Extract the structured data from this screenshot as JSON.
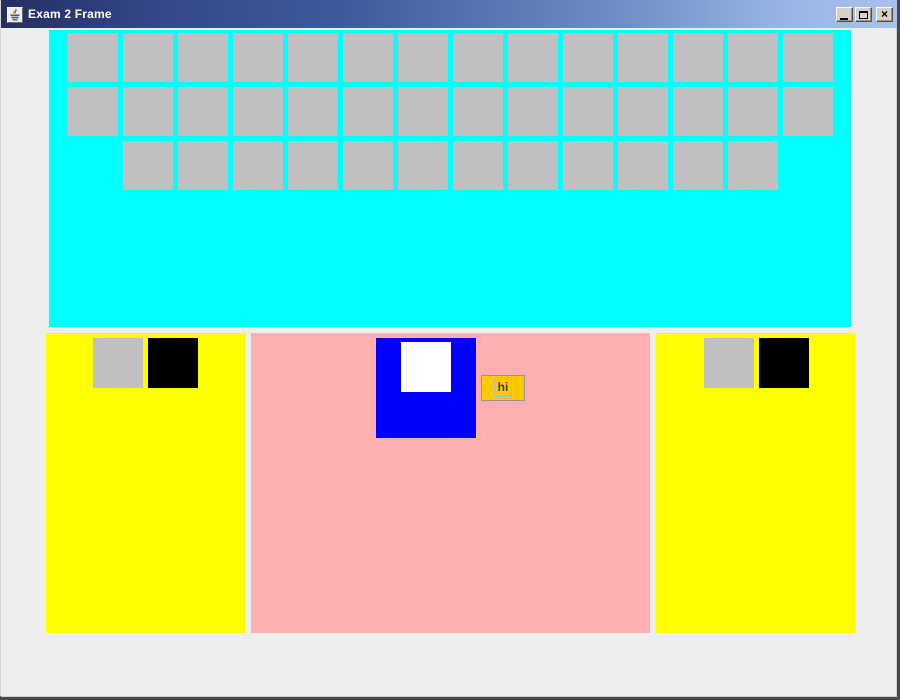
{
  "window": {
    "title": "Exam 2 Frame",
    "icon": "java-coffee-cup",
    "controls": {
      "minimize_label": "minimize",
      "maximize_label": "maximize",
      "close_label": "close"
    }
  },
  "colors": {
    "desktop_edge": "#4a4a46",
    "frame_background": "#eeeeee",
    "titlebar_left": "#232f63",
    "titlebar_right": "#a7c2ec",
    "top_panel": "#00ffff",
    "grid_button": "#c0c0c0",
    "side_panel": "#ffff00",
    "center_panel": "#ffafaf",
    "blue_panel": "#0000ff",
    "white_square": "#ffffff",
    "gray_square": "#c0c0c0",
    "black_square": "#000000",
    "hi_button_bg": "#ffc800"
  },
  "top_panel": {
    "grid_button_count": 40,
    "row_breakdown": [
      14,
      14,
      12
    ]
  },
  "left_panel": {
    "squares": [
      {
        "name": "gray-square",
        "color": "#c0c0c0"
      },
      {
        "name": "black-square",
        "color": "#000000"
      }
    ]
  },
  "center_panel": {
    "button_label": "hi"
  },
  "right_panel": {
    "squares": [
      {
        "name": "gray-square",
        "color": "#c0c0c0"
      },
      {
        "name": "black-square",
        "color": "#000000"
      }
    ]
  }
}
